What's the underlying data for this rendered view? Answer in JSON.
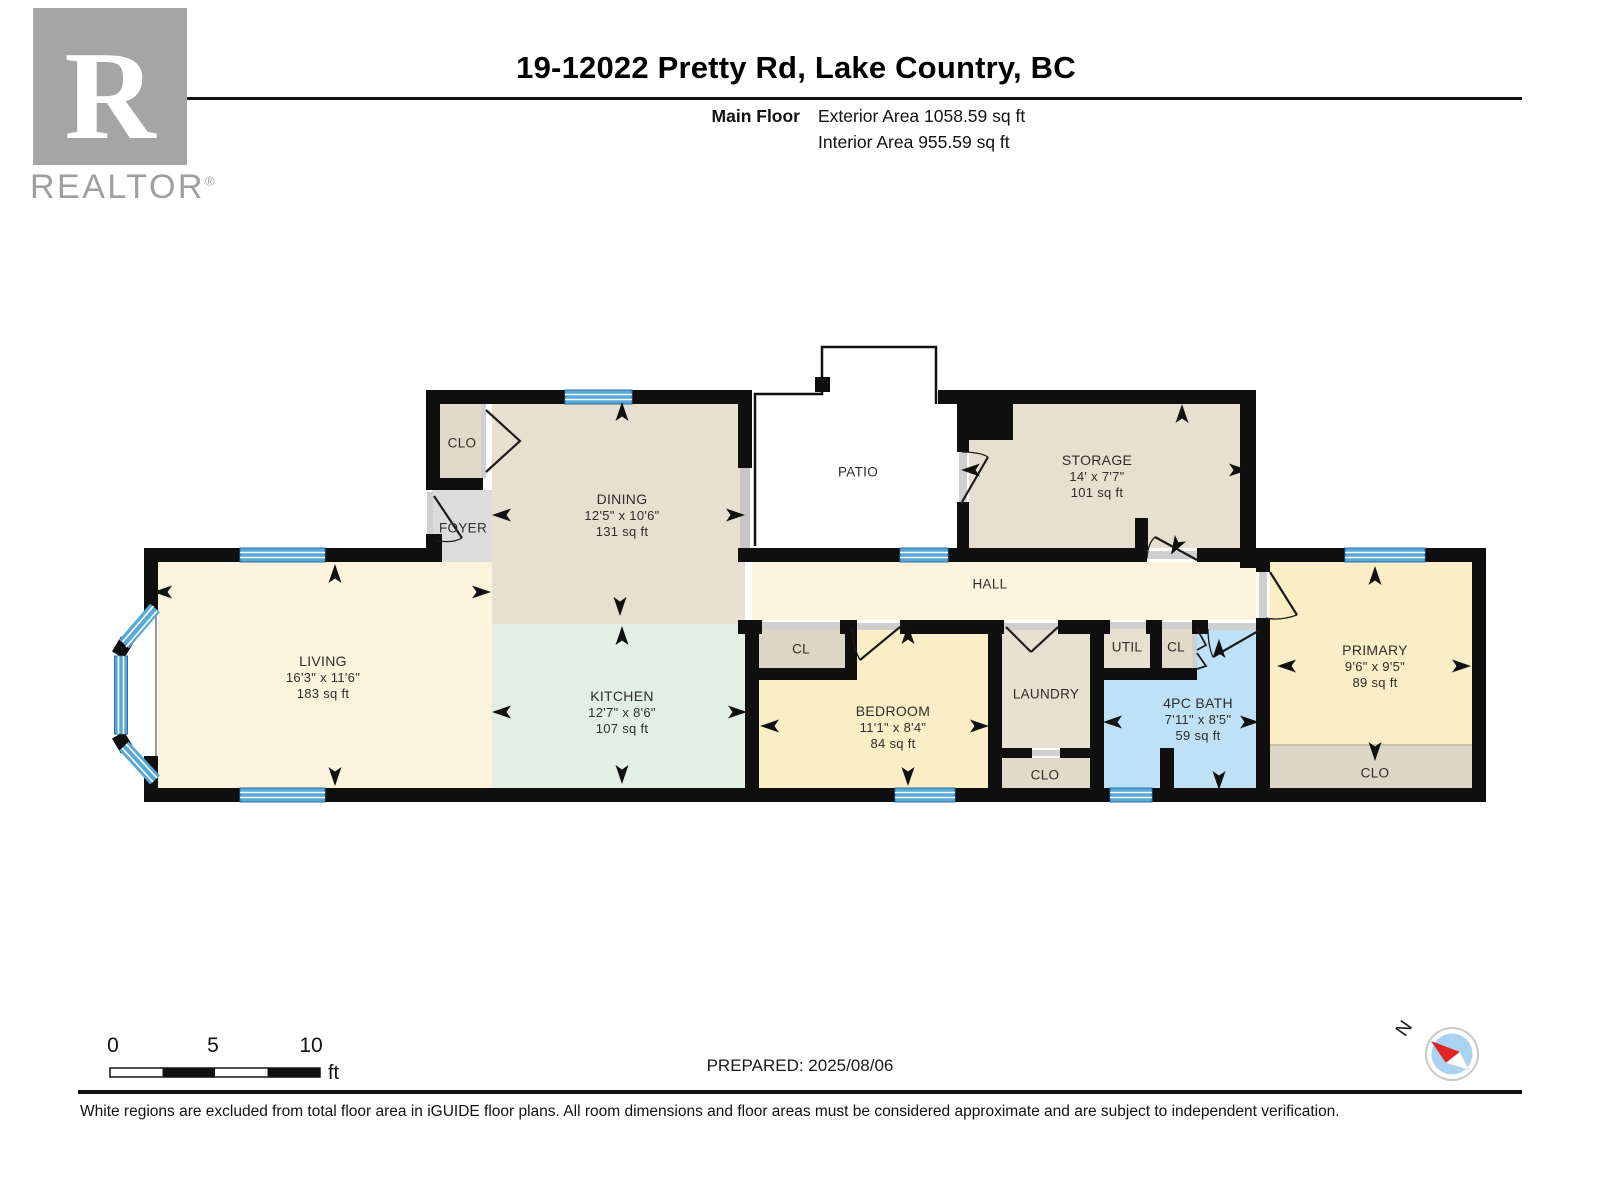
{
  "header": {
    "logo": {
      "letter": "R",
      "text": "REALTOR",
      "reg": "®"
    },
    "title": "19-12022 Pretty Rd, Lake Country, BC",
    "floor_label": "Main Floor",
    "exterior_area": "Exterior Area 1058.59 sq ft",
    "interior_area": "Interior Area 955.59 sq ft"
  },
  "plan": {
    "rooms": [
      {
        "id": "living",
        "name": "LIVING",
        "dims": "16'3\" x 11'6\"",
        "area": "183 sq ft"
      },
      {
        "id": "dining",
        "name": "DINING",
        "dims": "12'5\" x 10'6\"",
        "area": "131 sq ft"
      },
      {
        "id": "kitchen",
        "name": "KITCHEN",
        "dims": "12'7\" x 8'6\"",
        "area": "107 sq ft"
      },
      {
        "id": "storage",
        "name": "STORAGE",
        "dims": "14' x 7'7\"",
        "area": "101 sq ft"
      },
      {
        "id": "bedroom",
        "name": "BEDROOM",
        "dims": "11'1\" x 8'4\"",
        "area": "84 sq ft"
      },
      {
        "id": "bath",
        "name": "4PC BATH",
        "dims": "7'11\" x 8'5\"",
        "area": "59 sq ft"
      },
      {
        "id": "primary",
        "name": "PRIMARY",
        "dims": "9'6\" x 9'5\"",
        "area": "89 sq ft"
      }
    ],
    "labels": {
      "hall": "HALL",
      "patio": "PATIO",
      "foyer": "FOYER",
      "laundry": "LAUNDRY",
      "util": "UTIL",
      "closet_entry": "CLO",
      "closet_bedroom": "CL",
      "closet_hall": "CL",
      "closet_laundry": "CLO",
      "closet_primary": "CLO"
    },
    "colors": {
      "wall": "#0f0f0f",
      "window": "#57a9da",
      "room_cream": "#fbf3db",
      "room_tan": "#e7dfd0",
      "room_yellow": "#fbeec6",
      "room_mint": "#e2efe5",
      "room_blue": "#bee1f7",
      "foyer_grey": "#dcdcdc",
      "compass_blue": "#a9d3f1",
      "compass_red": "#e02423"
    }
  },
  "scale_bar": {
    "tick_0": "0",
    "tick_5": "5",
    "tick_10": "10",
    "unit": "ft"
  },
  "compass": {
    "north_label": "N"
  },
  "footer": {
    "prepared": "PREPARED: 2025/08/06",
    "disclaimer": "White regions are excluded from total floor area in iGUIDE floor plans. All room dimensions and floor areas must be considered approximate and are subject to independent verification."
  }
}
